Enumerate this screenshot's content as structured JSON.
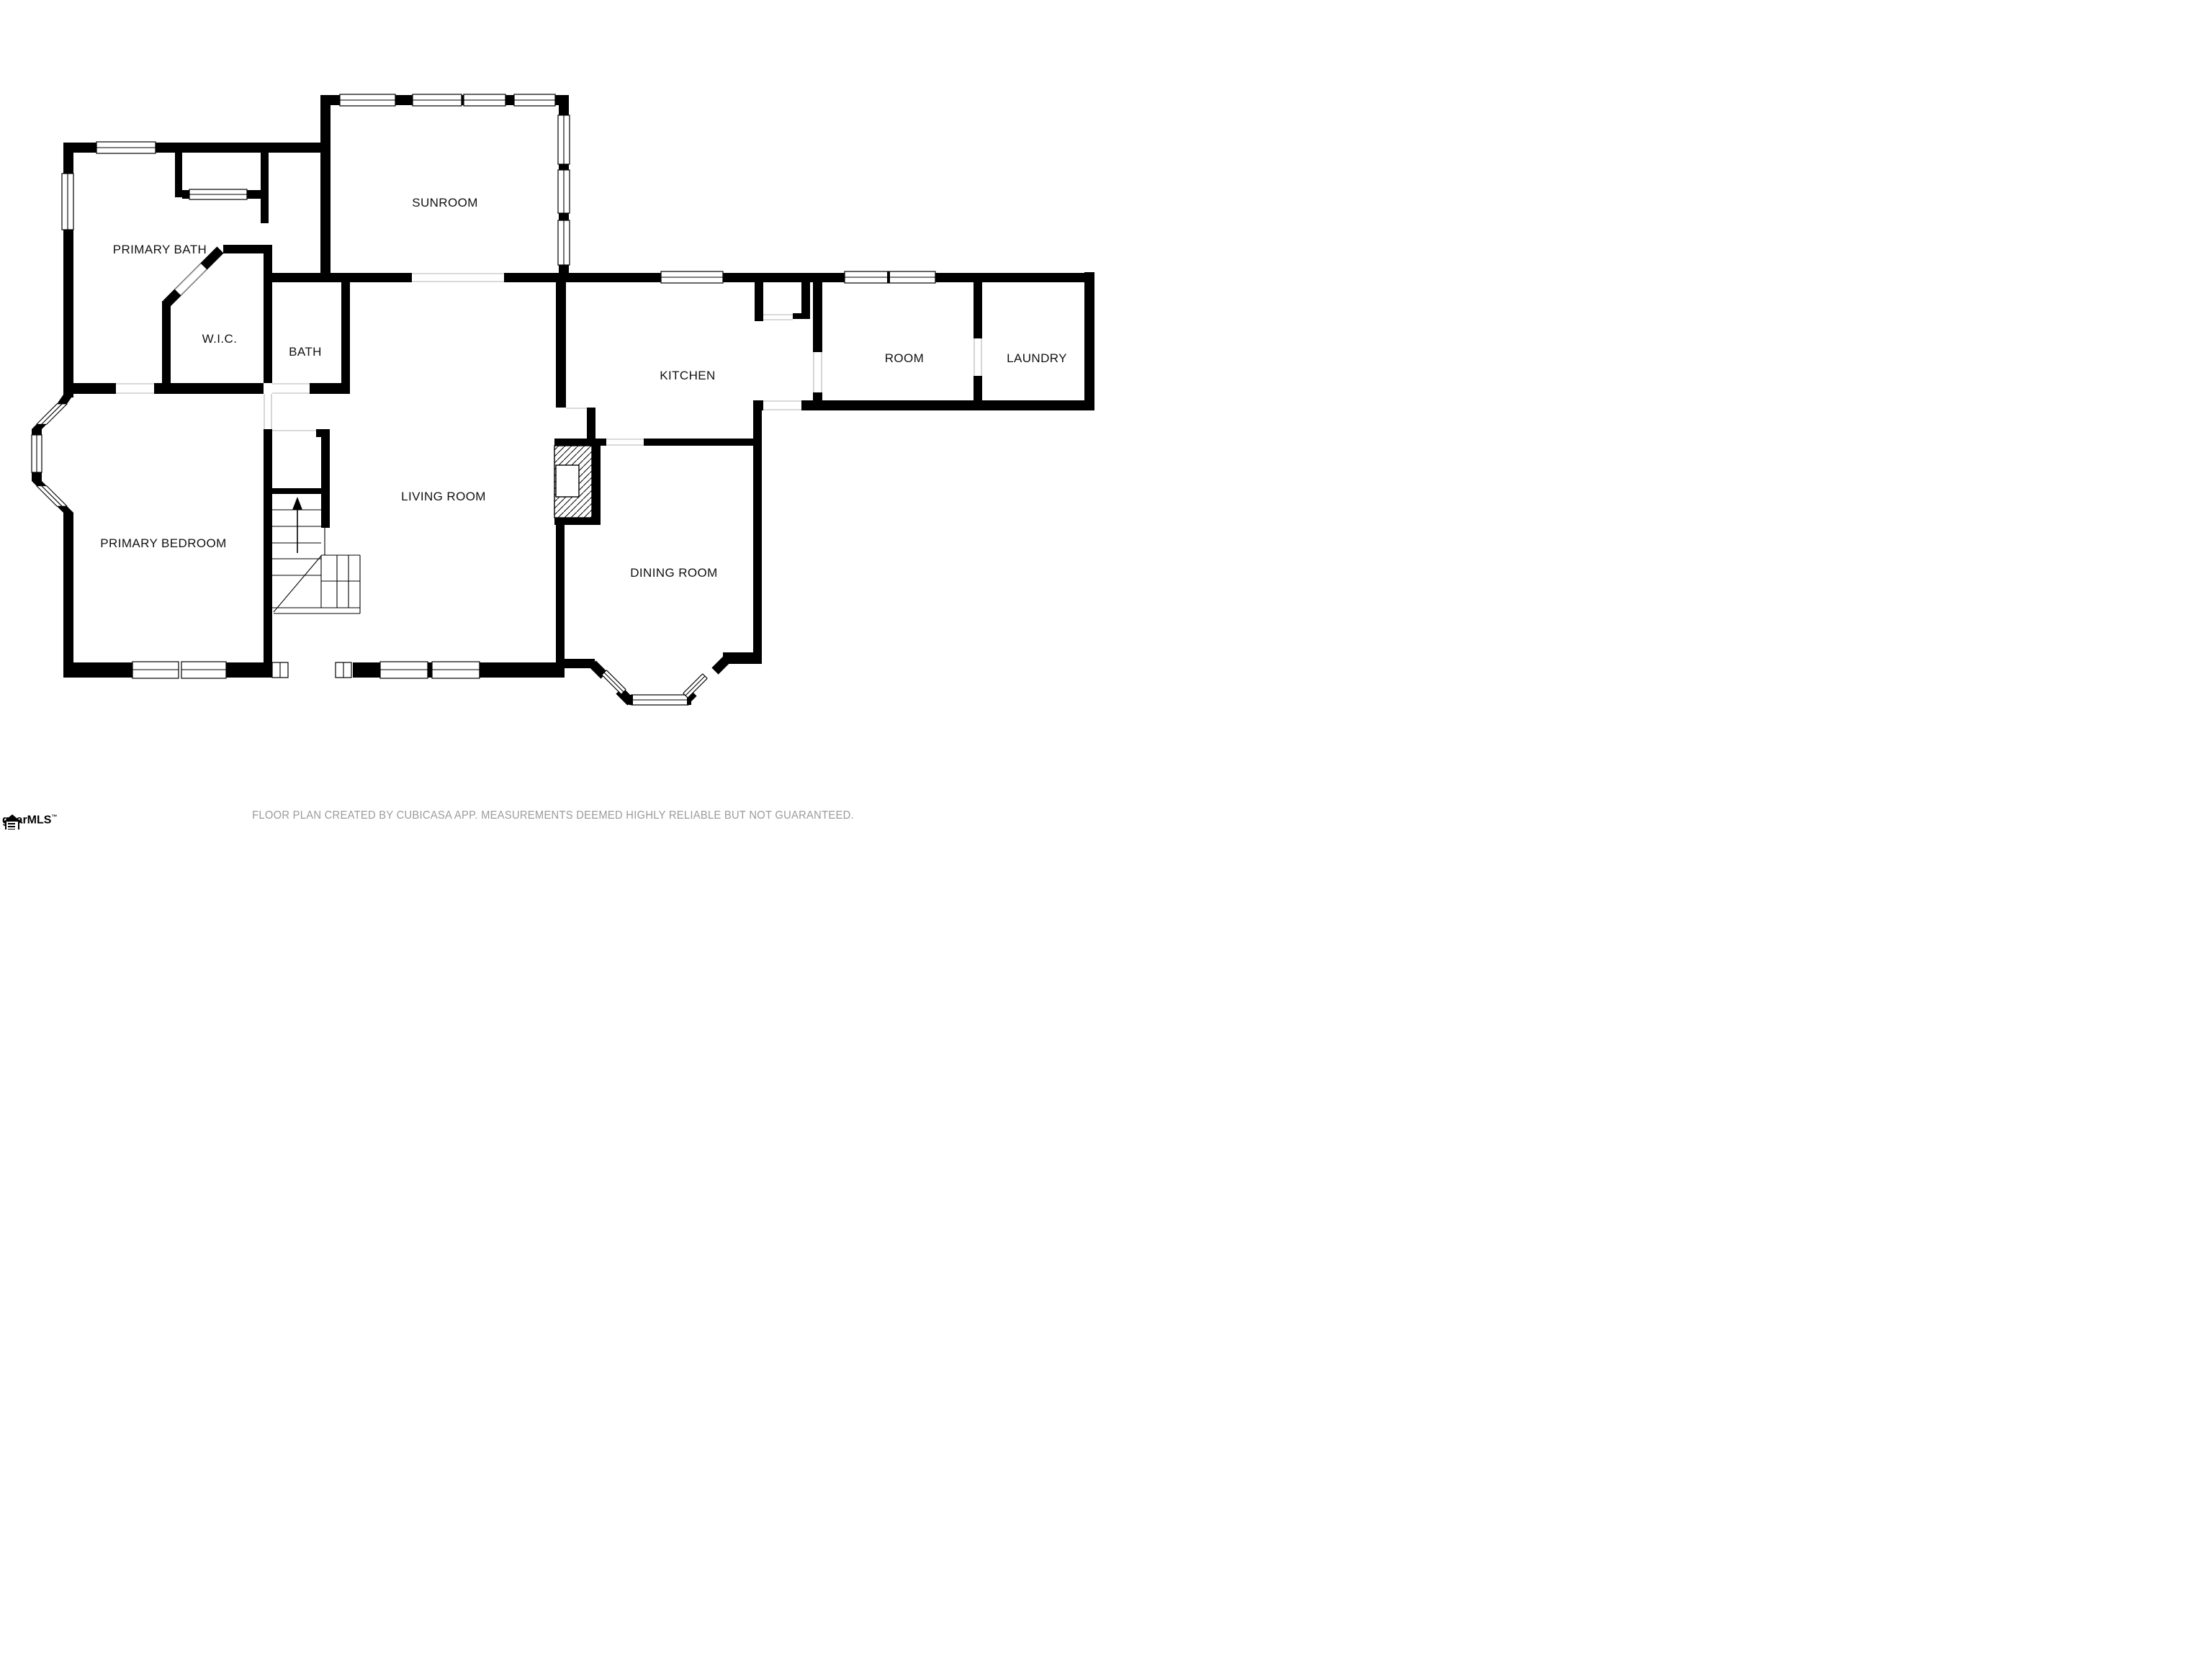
{
  "plan": {
    "rooms": {
      "sunroom": "SUNROOM",
      "primary_bath": "PRIMARY BATH",
      "wic": "W.I.C.",
      "bath": "BATH",
      "kitchen": "KITCHEN",
      "room": "ROOM",
      "laundry": "LAUNDRY",
      "living_room": "LIVING ROOM",
      "primary_bedroom": "PRIMARY BEDROOM",
      "dining_room": "DINING ROOM"
    }
  },
  "footer": {
    "disclaimer": "FLOOR PLAN CREATED BY CUBICASA APP. MEASUREMENTS DEEMED HIGHLY RELIABLE BUT NOT GUARANTEED."
  },
  "logo": {
    "text": "ggarMLS",
    "trademark": "™"
  },
  "colors": {
    "wall": "#000000",
    "label": "#111111",
    "footer_text": "#9b9b9b",
    "background": "#ffffff"
  }
}
